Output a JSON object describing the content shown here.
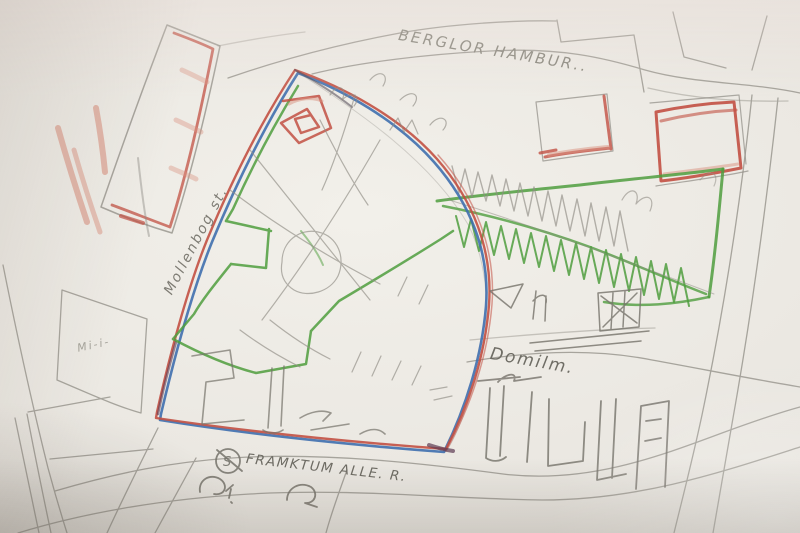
{
  "scene": {
    "description": "Hand-drawn pencil map sketch on paper with red, green and blue colored-pencil annotations",
    "labels": {
      "street_top": "BERGLOR HAMBUR..",
      "street_left": "Mollenbog st.",
      "district_right": "Domilm.",
      "street_bottom": "FRAMKTUM ALLE. R.",
      "block_left_note": "Mi-i-",
      "station_symbol": "S"
    },
    "colors": {
      "paper": "#eae7e1",
      "graphite": "#8f8c84",
      "red_pencil": "#c25043",
      "red_light": "#d9917f",
      "green_pencil": "#4f9e3e",
      "blue_pencil": "#3f6fae",
      "maroon_overlap": "#5e3b52"
    }
  }
}
